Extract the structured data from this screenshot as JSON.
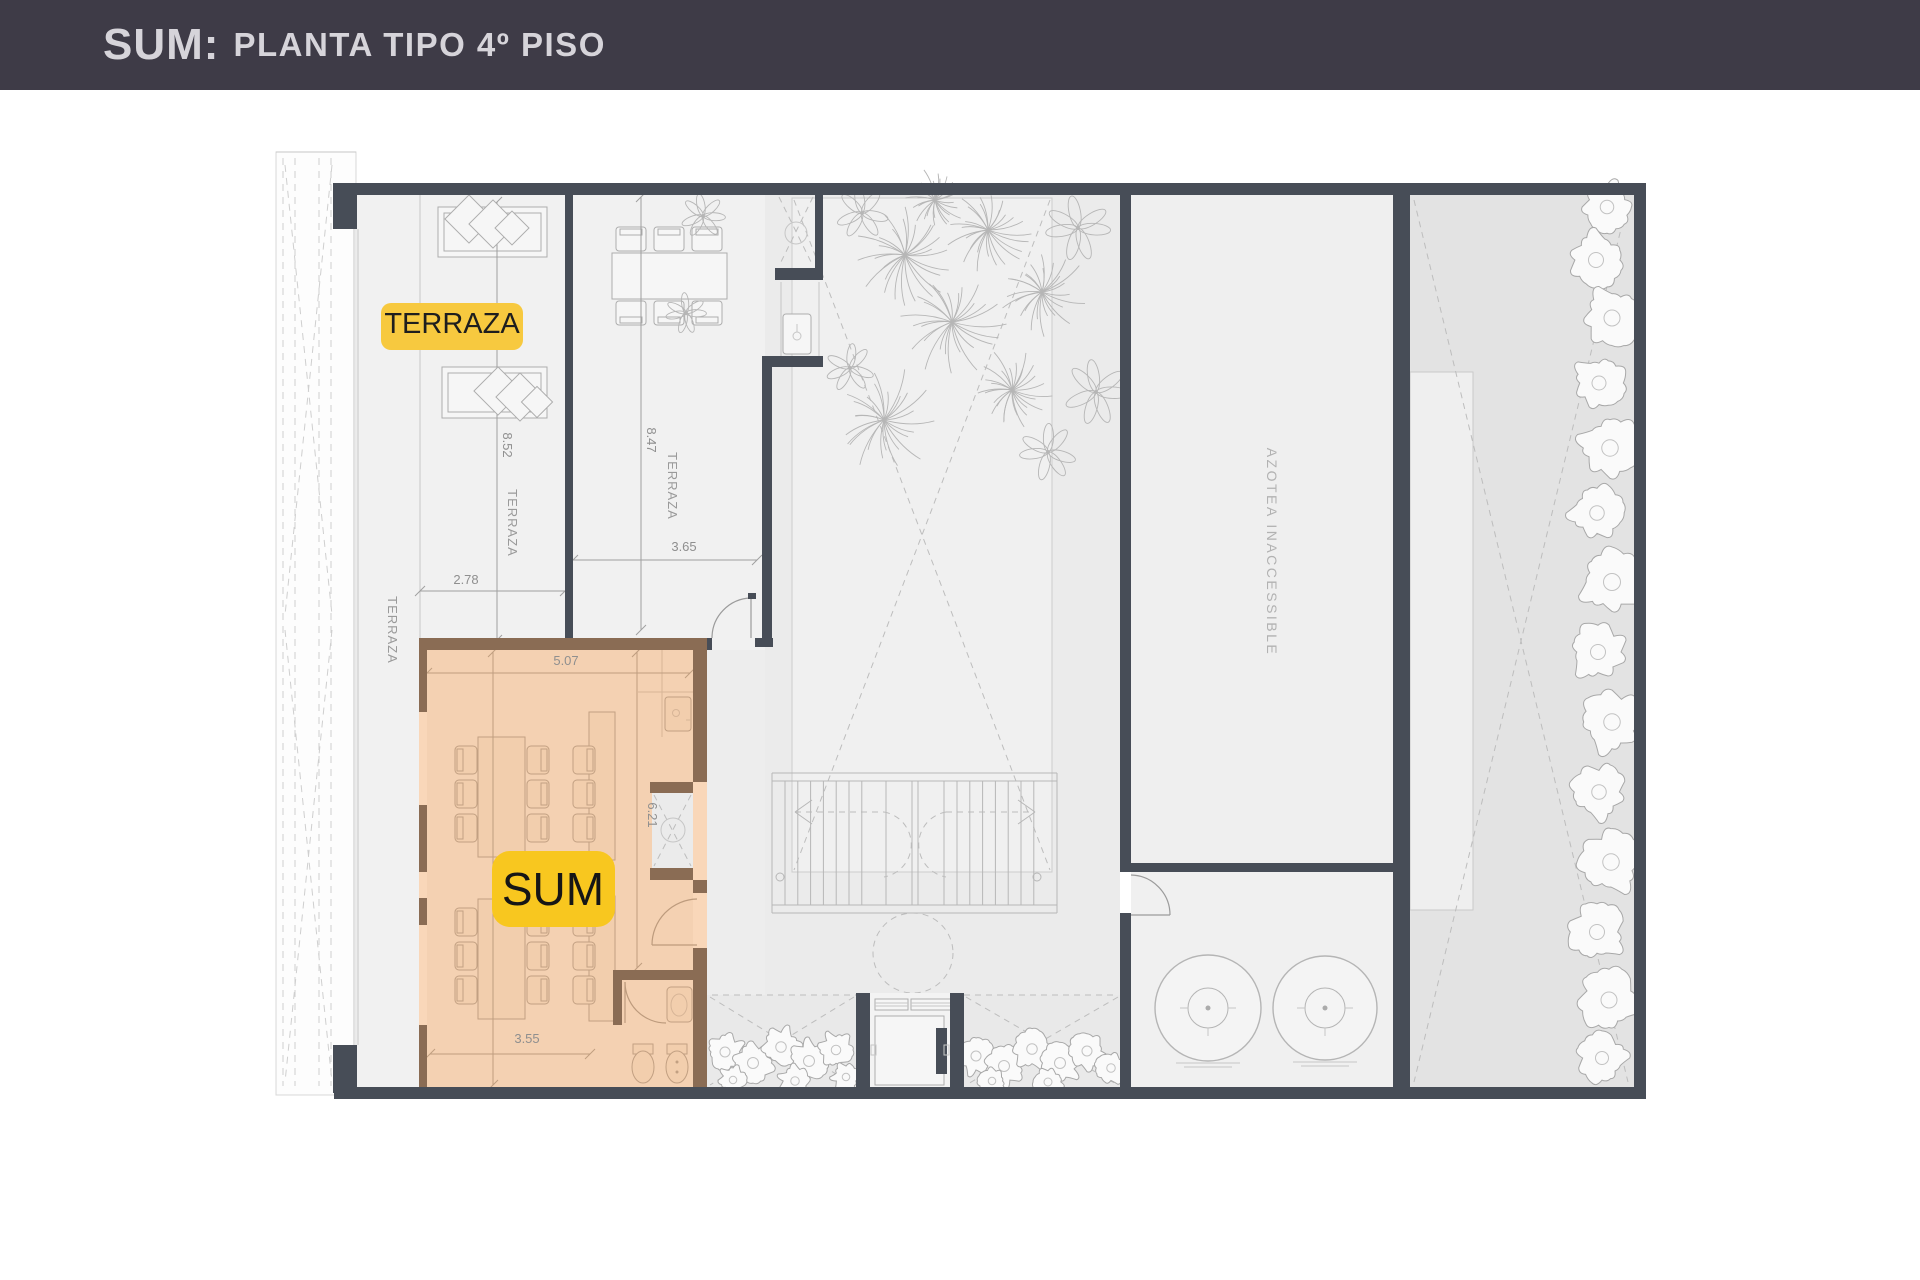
{
  "header": {
    "prefix": "SUM:",
    "title": "PLANTA TIPO 4º PISO"
  },
  "badges": {
    "terraza": "TERRAZA",
    "sum": "SUM"
  },
  "rooms": {
    "azotea": "AZOTEA INACCESSIBLE",
    "terraza_v_left": "TERRAZA",
    "terraza_v_mid": "TERRAZA",
    "terraza_v_dining": "TERRAZA"
  },
  "dimensions": {
    "terraza_mid_height": "8.52",
    "terraza_left_width": "2.78",
    "terraza_dining_height": "8.47",
    "terraza_dining_width": "3.65",
    "sum_width_top": "5.07",
    "sum_height_mid": "6.21",
    "sum_height_full": "8.40",
    "sum_width_bottom": "3.55"
  },
  "colors": {
    "header_bg": "#3E3B47",
    "header_text": "#D6D4DA",
    "wall": "#474D57",
    "highlight_yellow": "#F7C93F",
    "sum_highlight": "#EF9A50"
  }
}
